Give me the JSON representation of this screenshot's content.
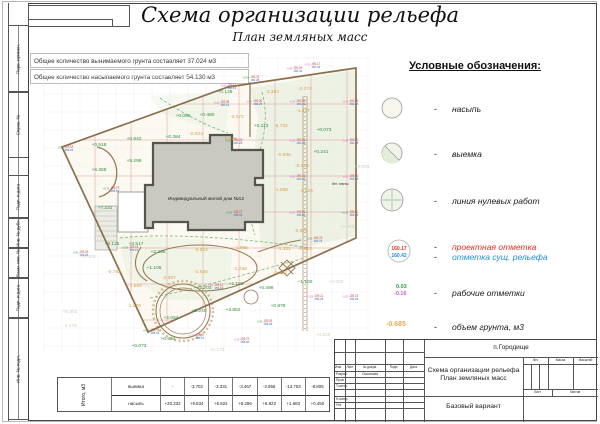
{
  "sheet": {
    "title": "Схема организации рельефа",
    "subtitle": "План земляных масс",
    "notes": [
      "Общее количество вынимаемого грунта составляет 37.024 м3",
      "Общее количество насыпаемого грунта составляет 54.130 м3"
    ],
    "margin_labels": [
      "Перв. примен.",
      "Справ. №",
      "Подп. и дата",
      "Инв. № дубл.",
      "Взам. инв. №",
      "Подп. и дата",
      "Инв. № подл."
    ]
  },
  "legend": {
    "title": "Условные обозначения:",
    "dash": "-",
    "items": [
      {
        "label": "насыпь",
        "symbol": "fill-circle"
      },
      {
        "label": "выемка",
        "symbol": "cut-circle"
      },
      {
        "label": "линия нулевых работ",
        "symbol": "zero-work-circle"
      },
      {
        "label": "проектная отметка",
        "label2": "отметка сущ. рельефа",
        "symbol": "elevation-circle",
        "sample_top": "160.17",
        "sample_bottom": "160.42"
      },
      {
        "label": "рабочие отметки",
        "symbol": "work-marks",
        "sample_top": "0.03",
        "sample_bottom": "-0.16"
      },
      {
        "label": "объем грунта, м3",
        "symbol": "volume-number",
        "sample": "-0.685"
      }
    ]
  },
  "colors": {
    "project_mark_red": "#d23333",
    "existing_mark_blue": "#3a66c9",
    "work_positive_green": "#2f9e44",
    "work_negative_magenta": "#cf5fd0",
    "volume_fill_green": "#2f8f3f",
    "volume_cut_orange": "#d9a14b",
    "boundary_brown": "#8a6f4d"
  },
  "plan": {
    "house_label": "Индивидуальный жилой дом №12",
    "note": "бет. плиты",
    "volumes": [
      {
        "x": 225,
        "y": 93,
        "v": "+0.126",
        "c": "fill"
      },
      {
        "x": 272,
        "y": 93,
        "v": "-3.363",
        "c": "cut"
      },
      {
        "x": 305,
        "y": 90,
        "v": "-3.274",
        "c": "cut"
      },
      {
        "x": 303,
        "y": 112,
        "v": "-1.337",
        "c": "cut"
      },
      {
        "x": 183,
        "y": 117,
        "v": "+0.066",
        "c": "fill"
      },
      {
        "x": 207,
        "y": 116,
        "v": "+0.480",
        "c": "fill"
      },
      {
        "x": 237,
        "y": 118,
        "v": "-0.472",
        "c": "cut"
      },
      {
        "x": 261,
        "y": 127,
        "v": "+0.113",
        "c": "fill"
      },
      {
        "x": 281,
        "y": 127,
        "v": "-5.732",
        "c": "cut"
      },
      {
        "x": 324,
        "y": 131,
        "v": "+0.073",
        "c": "fill"
      },
      {
        "x": 230,
        "y": 140,
        "v": "-0.025",
        "c": "cut"
      },
      {
        "x": 134,
        "y": 140,
        "v": "+0.942",
        "c": "fill"
      },
      {
        "x": 173,
        "y": 138,
        "v": "+0.384",
        "c": "fill"
      },
      {
        "x": 196,
        "y": 135,
        "v": "-0.003",
        "c": "cut"
      },
      {
        "x": 99,
        "y": 146,
        "v": "+0.518",
        "c": "fill"
      },
      {
        "x": 134,
        "y": 162,
        "v": "+5.298",
        "c": "fill"
      },
      {
        "x": 99,
        "y": 171,
        "v": "+6.368",
        "c": "fill"
      },
      {
        "x": 284,
        "y": 156,
        "v": "-0.685",
        "c": "cut"
      },
      {
        "x": 321,
        "y": 153,
        "v": "+0.241",
        "c": "fill"
      },
      {
        "x": 302,
        "y": 167,
        "v": "-0.334",
        "c": "cut"
      },
      {
        "x": 281,
        "y": 191,
        "v": "-1.088",
        "c": "cut"
      },
      {
        "x": 306,
        "y": 192,
        "v": "-1.225",
        "c": "cut"
      },
      {
        "x": 105,
        "y": 209,
        "v": "+7.231",
        "c": "fill"
      },
      {
        "x": 301,
        "y": 232,
        "v": "-0.875",
        "c": "cut"
      },
      {
        "x": 112,
        "y": 245,
        "v": "+6.125",
        "c": "fill"
      },
      {
        "x": 136,
        "y": 245,
        "v": "+3.517",
        "c": "fill"
      },
      {
        "x": 158,
        "y": 253,
        "v": "+2.235",
        "c": "fill"
      },
      {
        "x": 201,
        "y": 251,
        "v": "-0.822",
        "c": "cut"
      },
      {
        "x": 241,
        "y": 249,
        "v": "-1.956",
        "c": "cut"
      },
      {
        "x": 284,
        "y": 250,
        "v": "-1.121",
        "c": "cut"
      },
      {
        "x": 305,
        "y": 250,
        "v": "-0.613",
        "c": "cut"
      },
      {
        "x": 154,
        "y": 269,
        "v": "+1.106",
        "c": "fill"
      },
      {
        "x": 201,
        "y": 273,
        "v": "-2.630",
        "c": "cut"
      },
      {
        "x": 240,
        "y": 270,
        "v": "-1.246",
        "c": "cut"
      },
      {
        "x": 114,
        "y": 273,
        "v": "-0.782",
        "c": "cut"
      },
      {
        "x": 169,
        "y": 279,
        "v": "-2.507",
        "c": "cut"
      },
      {
        "x": 135,
        "y": 287,
        "v": "-1.684",
        "c": "cut"
      },
      {
        "x": 280,
        "y": 274,
        "v": "-1.434",
        "c": "cut"
      },
      {
        "x": 305,
        "y": 283,
        "v": "+1.100",
        "c": "fill"
      },
      {
        "x": 204,
        "y": 289,
        "v": "+2.203",
        "c": "fill"
      },
      {
        "x": 236,
        "y": 285,
        "v": "+2.181",
        "c": "fill"
      },
      {
        "x": 266,
        "y": 289,
        "v": "+0.499",
        "c": "fill"
      },
      {
        "x": 134,
        "y": 307,
        "v": "-1.276",
        "c": "cut"
      },
      {
        "x": 199,
        "y": 312,
        "v": "+5.240",
        "c": "fill"
      },
      {
        "x": 233,
        "y": 311,
        "v": "+3.852",
        "c": "fill"
      },
      {
        "x": 278,
        "y": 307,
        "v": "+0.878",
        "c": "fill"
      },
      {
        "x": 171,
        "y": 319,
        "v": "+2.064",
        "c": "fill"
      },
      {
        "x": 168,
        "y": 340,
        "v": "+0.634",
        "c": "fill"
      },
      {
        "x": 139,
        "y": 347,
        "v": "+0.073",
        "c": "fill"
      },
      {
        "x": 88,
        "y": 258,
        "v": "+0.003",
        "c": "faint"
      },
      {
        "x": 362,
        "y": 168,
        "v": "+0.003",
        "c": "faint"
      },
      {
        "x": 347,
        "y": 228,
        "v": "+0.005",
        "c": "faint"
      },
      {
        "x": 336,
        "y": 283,
        "v": "+0.002",
        "c": "faint"
      },
      {
        "x": 70,
        "y": 313,
        "v": "+0.303",
        "c": "faint"
      },
      {
        "x": 70,
        "y": 327,
        "v": "-3.176",
        "c": "faint"
      },
      {
        "x": 217,
        "y": 351,
        "v": "+0.273",
        "c": "faint"
      },
      {
        "x": 323,
        "y": 336,
        "v": "+0.529",
        "c": "faint"
      }
    ],
    "nodes": [
      {
        "x": 311,
        "y": 65,
        "t": "160.17",
        "b": "160.42",
        "w": "-0.25"
      },
      {
        "x": 293,
        "y": 69,
        "t": "160.04",
        "b": "160.44",
        "w": "-0.40"
      },
      {
        "x": 250,
        "y": 78,
        "t": "160.33",
        "b": "160.25",
        "w": "+0.08"
      },
      {
        "x": 227,
        "y": 86,
        "t": "160.17",
        "b": "160.19",
        "w": "-0.02"
      },
      {
        "x": 220,
        "y": 103,
        "t": "159.98",
        "b": "160.13",
        "w": "-0.15"
      },
      {
        "x": 253,
        "y": 102,
        "t": "160.20",
        "b": "160.25",
        "w": "-0.05"
      },
      {
        "x": 296,
        "y": 102,
        "t": "160.20",
        "b": "160.34",
        "w": "-0.14"
      },
      {
        "x": 349,
        "y": 102,
        "t": "160.19",
        "b": "160.34",
        "w": "-0.15"
      },
      {
        "x": 233,
        "y": 141,
        "t": "160.26",
        "b": "160.23",
        "w": "+0.03"
      },
      {
        "x": 296,
        "y": 141,
        "t": "160.26",
        "b": "160.28",
        "w": "-0.02"
      },
      {
        "x": 349,
        "y": 141,
        "t": "160.25",
        "b": "160.28",
        "w": "-0.03"
      },
      {
        "x": 296,
        "y": 177,
        "t": "160.18",
        "b": "160.26",
        "w": "-0.08"
      },
      {
        "x": 349,
        "y": 177,
        "t": "159.95",
        "b": "159.96",
        "w": "-0.01"
      },
      {
        "x": 296,
        "y": 213,
        "t": "159.82",
        "b": "159.86",
        "w": "-0.04"
      },
      {
        "x": 349,
        "y": 213,
        "t": "159.81",
        "b": "159.76",
        "w": "+0.05"
      },
      {
        "x": 313,
        "y": 239,
        "t": "159.76",
        "b": "159.76",
        "w": "0.00"
      },
      {
        "x": 64,
        "y": 148,
        "t": "159.53",
        "b": "159.53",
        "w": "0.00"
      },
      {
        "x": 110,
        "y": 189,
        "t": "159.73",
        "b": "159.62",
        "w": "+0.11"
      },
      {
        "x": 79,
        "y": 253,
        "t": "159.35",
        "b": "159.35",
        "w": "0.00"
      },
      {
        "x": 150,
        "y": 331,
        "t": "158.41",
        "b": "158.34",
        "w": "+0.07"
      },
      {
        "x": 195,
        "y": 336,
        "t": "158.47",
        "b": "158.51",
        "w": "-0.04"
      },
      {
        "x": 240,
        "y": 340,
        "t": "158.76",
        "b": "158.90",
        "w": "-0.14"
      },
      {
        "x": 263,
        "y": 322,
        "t": "159.06",
        "b": "159.06",
        "w": "0.00"
      },
      {
        "x": 314,
        "y": 297,
        "t": "159.21",
        "b": "159.26",
        "w": "-0.05"
      },
      {
        "x": 349,
        "y": 297,
        "t": "159.23",
        "b": "159.26",
        "w": "-0.03"
      },
      {
        "x": 233,
        "y": 213,
        "t": "159.72",
        "b": "159.69",
        "w": "+0.03"
      },
      {
        "x": 214,
        "y": 286,
        "t": "159.11",
        "b": "159.16",
        "w": "-0.05"
      },
      {
        "x": 129,
        "y": 248,
        "t": "159.16",
        "b": "159.10",
        "w": "+0.06"
      }
    ]
  },
  "totals_table": {
    "row_header": "Итого, м3",
    "rows": [
      {
        "label": "выемка",
        "values": [
          "-",
          "-3.702",
          "-3.331",
          "-3.467",
          "-3.966",
          "-13.753",
          "-8.805"
        ]
      },
      {
        "label": "насыпь",
        "values": [
          "+20.232",
          "+9.834",
          "+6.822",
          "+8.286",
          "+6.823",
          "+1.683",
          "+0.450"
        ]
      }
    ]
  },
  "title_block": {
    "location": "п.Городище",
    "doc_title_line1": "Схема организации рельефа",
    "doc_title_line2": "План земляных масс",
    "variant": "Базовый вариант",
    "columns": [
      "Изм",
      "Лист",
      "№ докум.",
      "Подп.",
      "Дата"
    ],
    "rows": [
      {
        "label": "Разраб.",
        "value": "Осколкова"
      },
      {
        "label": "Пров.",
        "value": ""
      },
      {
        "label": "Т.контр.",
        "value": ""
      },
      {
        "label": "Н.контр.",
        "value": ""
      },
      {
        "label": "Утв.",
        "value": ""
      }
    ],
    "right_headers": [
      "Лит.",
      "Масса",
      "Масштаб"
    ],
    "sheet_labels": [
      "Лист",
      "Листов"
    ]
  }
}
